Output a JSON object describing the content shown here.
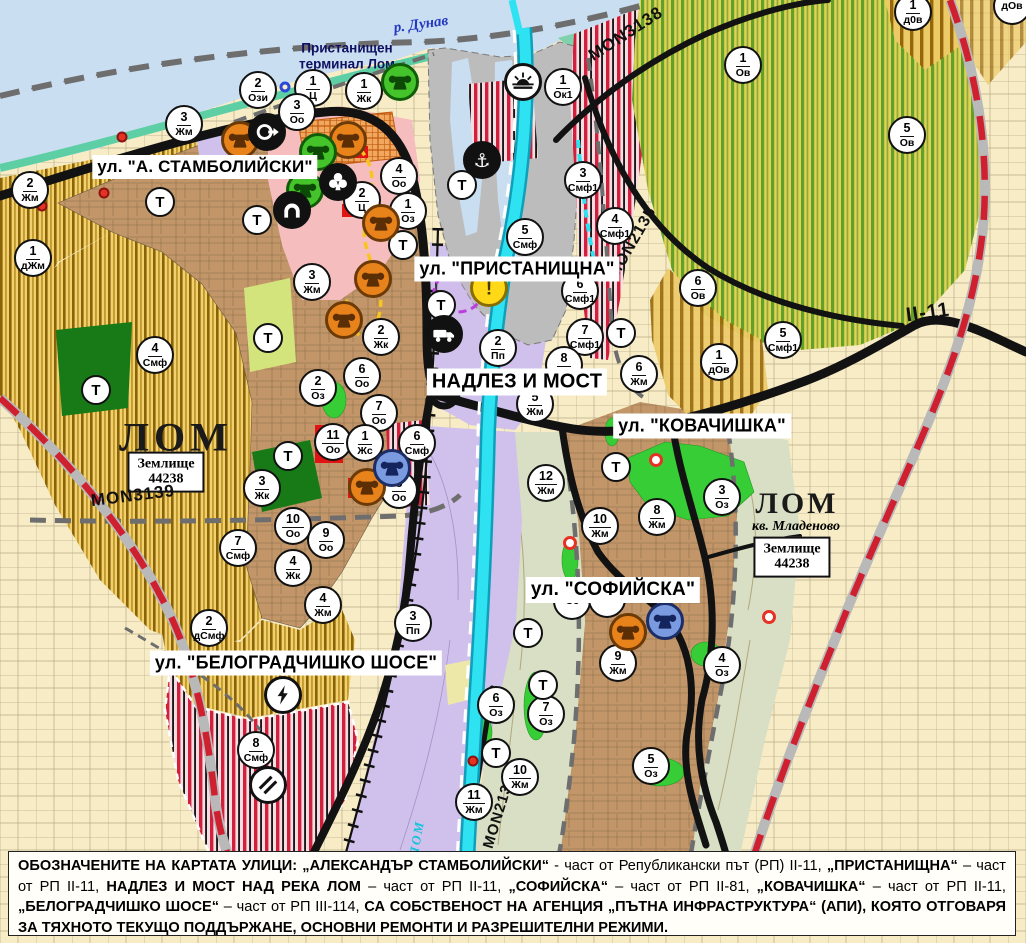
{
  "map": {
    "t_label": "Т",
    "labels": {
      "river_danube": "р. Дунав",
      "river_lom": "ЛОМ",
      "terminal_line1": "Пристанищен",
      "terminal_line2": "терминал Лом",
      "city_left": "ЛОМ",
      "city_right": "ЛОМ",
      "district": "кв. Младеново",
      "landplot_title": "Землище",
      "landplot_number": "44238"
    },
    "street_labels": [
      {
        "id": "stamboliyski",
        "text": "ул. \"А. СТАМБОЛИЙСКИ\"",
        "x": 205,
        "y": 167,
        "fs": 17
      },
      {
        "id": "pristanishtna",
        "text": "ул. \"ПРИСТАНИЩНА\"",
        "x": 517,
        "y": 269,
        "fs": 18
      },
      {
        "id": "nadlez-i-most",
        "text": "НАДЛЕЗ И МОСТ",
        "x": 517,
        "y": 382,
        "fs": 20
      },
      {
        "id": "kovachishka",
        "text": "ул. \"КОВАЧИШКА\"",
        "x": 702,
        "y": 426,
        "fs": 18
      },
      {
        "id": "sofiyska",
        "text": "ул. \"СОФИЙСКА\"",
        "x": 613,
        "y": 590,
        "fs": 19
      },
      {
        "id": "belogradchishko-shose",
        "text": "ул. \"БЕЛОГРАДЧИШКО ШОСЕ\"",
        "x": 296,
        "y": 663,
        "fs": 18
      }
    ],
    "road_labels": [
      {
        "text": "MON3138",
        "x": 626,
        "y": 34,
        "rot": -33,
        "fs": 17
      },
      {
        "text": "MON2135",
        "x": 633,
        "y": 243,
        "rot": -60,
        "fs": 16
      },
      {
        "text": "MON3139",
        "x": 133,
        "y": 496,
        "rot": -7,
        "fs": 17
      },
      {
        "text": "MON2136",
        "x": 499,
        "y": 812,
        "rot": -73,
        "fs": 15
      },
      {
        "text": "II-11",
        "x": 928,
        "y": 313,
        "rot": -8,
        "fs": 20
      }
    ],
    "zone_markers": [
      {
        "n": "2",
        "c": "Ози",
        "x": 258,
        "y": 90
      },
      {
        "n": "1",
        "c": "Ц",
        "x": 313,
        "y": 88
      },
      {
        "n": "3",
        "c": "Оо",
        "x": 297,
        "y": 112
      },
      {
        "n": "1",
        "c": "Жк",
        "x": 364,
        "y": 91
      },
      {
        "n": "4",
        "c": "Оо",
        "x": 399,
        "y": 176
      },
      {
        "n": "2",
        "c": "Ц",
        "x": 362,
        "y": 200
      },
      {
        "n": "1",
        "c": "Оз",
        "x": 408,
        "y": 211
      },
      {
        "n": "3",
        "c": "Жм",
        "x": 184,
        "y": 124
      },
      {
        "n": "2",
        "c": "Жм",
        "x": 30,
        "y": 190
      },
      {
        "n": "1",
        "c": "дЖм",
        "x": 33,
        "y": 258
      },
      {
        "n": "1",
        "c": "Ок1",
        "x": 563,
        "y": 87
      },
      {
        "n": "1",
        "c": "Ов",
        "x": 743,
        "y": 65
      },
      {
        "n": "5",
        "c": "Ов",
        "x": 907,
        "y": 135
      },
      {
        "n": "1",
        "c": "д0в",
        "x": 913,
        "y": 12
      },
      {
        "n": "",
        "c": "дОв",
        "x": 1012,
        "y": 6
      },
      {
        "n": "3",
        "c": "Смф1",
        "x": 583,
        "y": 180
      },
      {
        "n": "4",
        "c": "Смф1",
        "x": 615,
        "y": 226
      },
      {
        "n": "5",
        "c": "Смф",
        "x": 525,
        "y": 237
      },
      {
        "n": "6",
        "c": "Смф1",
        "x": 580,
        "y": 291
      },
      {
        "n": "7",
        "c": "Смф1",
        "x": 585,
        "y": 337
      },
      {
        "n": "6",
        "c": "Ов",
        "x": 698,
        "y": 288
      },
      {
        "n": "1",
        "c": "дОв",
        "x": 719,
        "y": 362
      },
      {
        "n": "5",
        "c": "Смф1",
        "x": 783,
        "y": 340
      },
      {
        "n": "2",
        "c": "Пп",
        "x": 498,
        "y": 348
      },
      {
        "n": "8",
        "c": "Жм",
        "x": 564,
        "y": 365
      },
      {
        "n": "5",
        "c": "Жм",
        "x": 535,
        "y": 404
      },
      {
        "n": "6",
        "c": "Жм",
        "x": 639,
        "y": 374
      },
      {
        "n": "12",
        "c": "Жм",
        "x": 546,
        "y": 483
      },
      {
        "n": "10",
        "c": "Жм",
        "x": 600,
        "y": 526
      },
      {
        "n": "8",
        "c": "Жм",
        "x": 657,
        "y": 517
      },
      {
        "n": "3",
        "c": "Оз",
        "x": 722,
        "y": 497
      },
      {
        "n": "3",
        "c": "Жм",
        "x": 312,
        "y": 282
      },
      {
        "n": "2",
        "c": "Жк",
        "x": 381,
        "y": 337
      },
      {
        "n": "2",
        "c": "Оз",
        "x": 318,
        "y": 388
      },
      {
        "n": "6",
        "c": "Оо",
        "x": 362,
        "y": 376
      },
      {
        "n": "7",
        "c": "Оо",
        "x": 379,
        "y": 413
      },
      {
        "n": "11",
        "c": "Оо",
        "x": 333,
        "y": 442
      },
      {
        "n": "1",
        "c": "Жс",
        "x": 365,
        "y": 443
      },
      {
        "n": "6",
        "c": "Смф",
        "x": 417,
        "y": 443
      },
      {
        "n": "8",
        "c": "Оо",
        "x": 399,
        "y": 490
      },
      {
        "n": "3",
        "c": "Жк",
        "x": 262,
        "y": 488
      },
      {
        "n": "10",
        "c": "Оо",
        "x": 293,
        "y": 526
      },
      {
        "n": "9",
        "c": "Оо",
        "x": 326,
        "y": 540
      },
      {
        "n": "4",
        "c": "Жк",
        "x": 293,
        "y": 568
      },
      {
        "n": "7",
        "c": "Смф",
        "x": 238,
        "y": 548
      },
      {
        "n": "4",
        "c": "Смф",
        "x": 155,
        "y": 355
      },
      {
        "n": "4",
        "c": "Жм",
        "x": 323,
        "y": 605
      },
      {
        "n": "3",
        "c": "Пп",
        "x": 413,
        "y": 623
      },
      {
        "n": "2",
        "c": "дСмф",
        "x": 209,
        "y": 628
      },
      {
        "n": "8",
        "c": "Смф",
        "x": 256,
        "y": 750
      },
      {
        "n": "",
        "c": "Оз",
        "x": 572,
        "y": 601
      },
      {
        "n": "",
        "c": "Оз",
        "x": 607,
        "y": 599
      },
      {
        "n": "9",
        "c": "Жм",
        "x": 618,
        "y": 663
      },
      {
        "n": "6",
        "c": "Оз",
        "x": 496,
        "y": 705
      },
      {
        "n": "7",
        "c": "Оз",
        "x": 546,
        "y": 714
      },
      {
        "n": "5",
        "c": "Оз",
        "x": 651,
        "y": 766
      },
      {
        "n": "10",
        "c": "Жм",
        "x": 520,
        "y": 777
      },
      {
        "n": "11",
        "c": "Жм",
        "x": 474,
        "y": 802
      },
      {
        "n": "4",
        "c": "Оз",
        "x": 722,
        "y": 665
      }
    ],
    "t_markers": [
      {
        "x": 160,
        "y": 202
      },
      {
        "x": 257,
        "y": 220
      },
      {
        "x": 96,
        "y": 390
      },
      {
        "x": 268,
        "y": 338
      },
      {
        "x": 288,
        "y": 456
      },
      {
        "x": 403,
        "y": 245
      },
      {
        "x": 441,
        "y": 305
      },
      {
        "x": 462,
        "y": 185
      },
      {
        "x": 621,
        "y": 333
      },
      {
        "x": 616,
        "y": 467
      },
      {
        "x": 528,
        "y": 633
      },
      {
        "x": 543,
        "y": 685
      },
      {
        "x": 496,
        "y": 753
      }
    ],
    "icon_markers": [
      {
        "type": "monument-orange",
        "x": 240,
        "y": 140
      },
      {
        "type": "monument-orange",
        "x": 348,
        "y": 140
      },
      {
        "type": "monument-orange",
        "x": 381,
        "y": 223
      },
      {
        "type": "monument-orange",
        "x": 373,
        "y": 279
      },
      {
        "type": "monument-orange",
        "x": 344,
        "y": 320
      },
      {
        "type": "monument-orange",
        "x": 367,
        "y": 487
      },
      {
        "type": "monument-orange",
        "x": 628,
        "y": 632
      },
      {
        "type": "monument-green",
        "x": 400,
        "y": 82
      },
      {
        "type": "monument-green",
        "x": 318,
        "y": 152
      },
      {
        "type": "monument-green",
        "x": 305,
        "y": 190
      },
      {
        "type": "monument-blue",
        "x": 392,
        "y": 468
      },
      {
        "type": "monument-blue",
        "x": 665,
        "y": 621
      },
      {
        "type": "pump-station",
        "x": 267,
        "y": 132
      },
      {
        "type": "club",
        "x": 338,
        "y": 182
      },
      {
        "type": "tunnel",
        "x": 292,
        "y": 210
      },
      {
        "type": "anchor",
        "x": 482,
        "y": 160
      },
      {
        "type": "lighthouse",
        "x": 523,
        "y": 82
      },
      {
        "type": "truck",
        "x": 444,
        "y": 334
      },
      {
        "type": "warning",
        "x": 489,
        "y": 288
      },
      {
        "type": "power",
        "x": 283,
        "y": 695
      },
      {
        "type": "rail-crossing",
        "x": 268,
        "y": 785
      }
    ],
    "poi": [
      {
        "type": "red-dot",
        "x": 122,
        "y": 137
      },
      {
        "type": "red-dot",
        "x": 104,
        "y": 193
      },
      {
        "type": "red-dot",
        "x": 42,
        "y": 206
      },
      {
        "type": "red-dot",
        "x": 473,
        "y": 761
      },
      {
        "type": "red-ring",
        "x": 656,
        "y": 460
      },
      {
        "type": "red-ring",
        "x": 769,
        "y": 617
      },
      {
        "type": "red-ring",
        "x": 570,
        "y": 543
      },
      {
        "type": "blue-ring",
        "x": 285,
        "y": 87
      }
    ]
  },
  "colors": {
    "water": "#c9def1",
    "shore": "#5ecfa5",
    "orchard_bg": "#dcd455",
    "orchard_stripe": "#63a02b",
    "town": "#c29669",
    "yellow_zone": "#f1d06e",
    "red_stripe": "#d2203c",
    "purple_zone": "#cfc0ec",
    "pink_zone": "#f5bdbd",
    "port_gray": "#bcbcbc",
    "river_cyan": "#2fe2f2",
    "sage": "#d8dfc4",
    "road_black": "#121212",
    "republican_red": "#cf2030",
    "marker_orange": "#e8821a",
    "marker_green": "#44c32a",
    "marker_blue": "#7b9be0"
  },
  "caption": {
    "segments": [
      {
        "b": true,
        "t": "ОБОЗНАЧЕНИТЕ НА КАРТАТА УЛИЦИ: „АЛЕКСАНДЪР СТАМБОЛИЙСКИ“"
      },
      {
        "b": false,
        "t": " - част от Републикански път (РП) II-11, "
      },
      {
        "b": true,
        "t": "„ПРИСТАНИЩНА“"
      },
      {
        "b": false,
        "t": " – част от РП II-11, "
      },
      {
        "b": true,
        "t": "НАДЛЕЗ И МОСТ НАД РЕКА ЛОМ"
      },
      {
        "b": false,
        "t": " – част от РП II-11, "
      },
      {
        "b": true,
        "t": "„СОФИЙСКА“"
      },
      {
        "b": false,
        "t": " – част от РП II-81, "
      },
      {
        "b": true,
        "t": "„КОВАЧИШКА“"
      },
      {
        "b": false,
        "t": " – част от РП II-11, "
      },
      {
        "b": true,
        "t": "„БЕЛОГРАДЧИШКО ШОСЕ“"
      },
      {
        "b": false,
        "t": " – част от РП III-114, "
      },
      {
        "b": true,
        "t": "СА СОБСТВЕНОСТ НА АГЕНЦИЯ „ПЪТНА ИНФРАСТРУКТУРА“ (АПИ), КОЯТО ОТГОВАРЯ ЗА ТЯХНОТО ТЕКУЩО ПОДДЪРЖАНЕ, ОСНОВНИ РЕМОНТИ И РАЗРЕШИТЕЛНИ РЕЖИМИ."
      }
    ]
  }
}
